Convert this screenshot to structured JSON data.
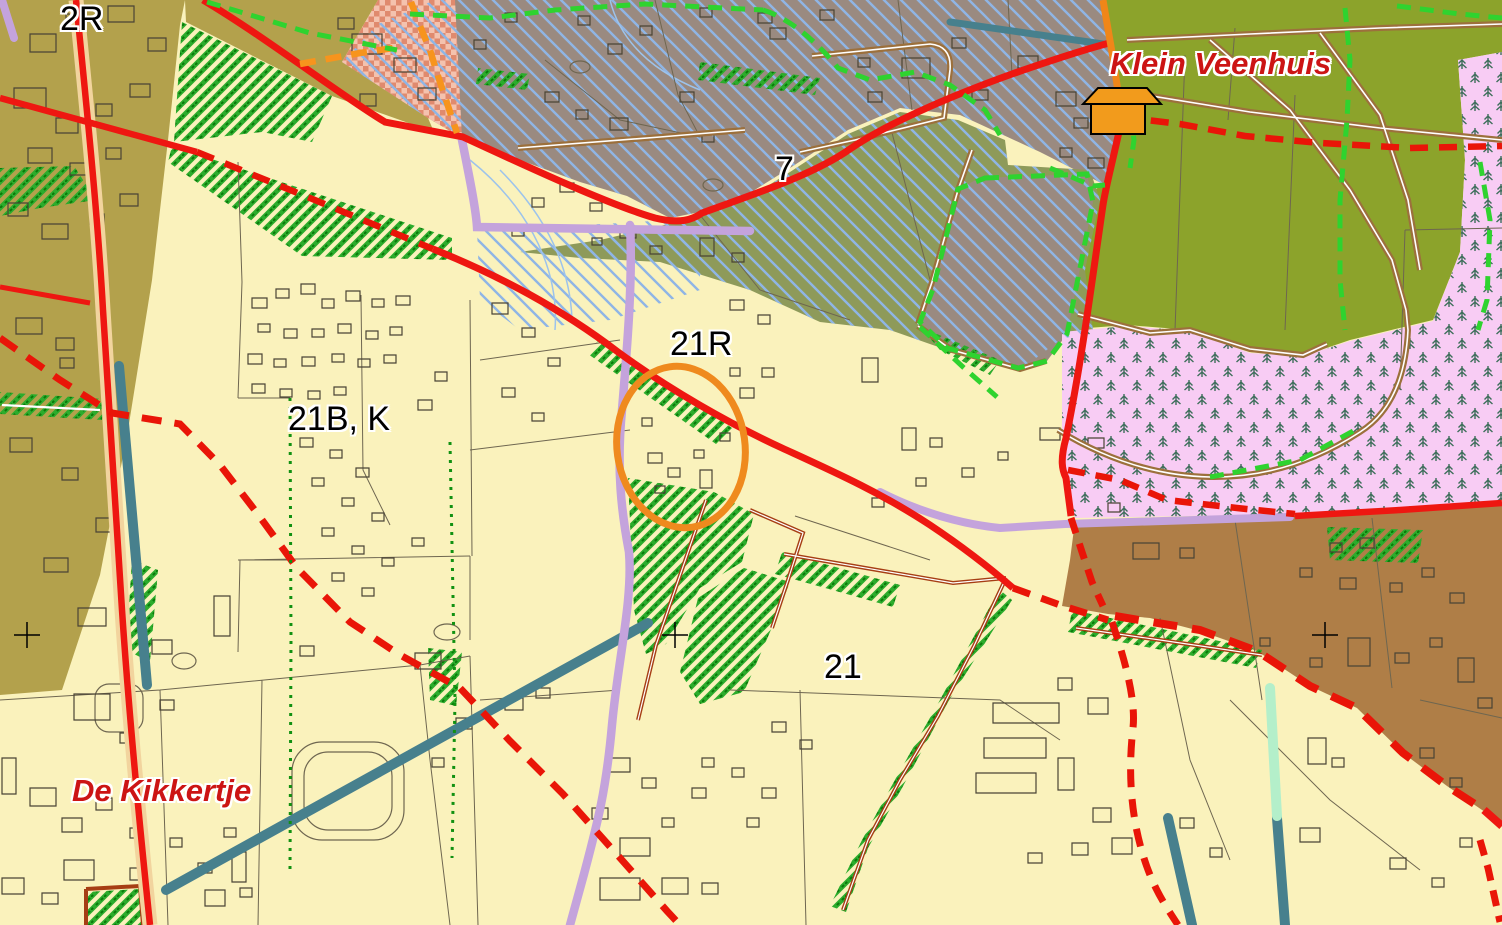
{
  "map": {
    "type": "topographic-zoning-map",
    "labels": {
      "zone_2r": "2R",
      "zone_21bk": "21B, K",
      "zone_21r": "21R",
      "zone_7": "7",
      "zone_21": "21",
      "place_klein_veenhuis": "Klein Veenhuis",
      "place_de_kikkertje": "De Kikkertje"
    },
    "palette": {
      "base_parcel": "#FAF2BC",
      "olive_zone": "#B3A14C",
      "gray_zone": "#9A8A80",
      "olive_drab_zone": "#8E9A5A",
      "bright_green_zone": "#8CA32B",
      "forest_pink": "#F8CCF4",
      "forest_tree": "#3D6E5A",
      "brown_zone": "#AF7E47",
      "checker_salmon": "#E08A6E",
      "road_red": "#EE1711",
      "road_casing": "#F2D49E",
      "road_purple": "#C4A3DC",
      "road_brown": "#9C703C",
      "hedge_red_brown": "#A63E14",
      "boundary_green_dash": "#2FD32F",
      "boundary_orange_dash": "#F7941D",
      "hatch_green": "#2CAC2C",
      "hatch_blue": "#8FB5E5",
      "water_teal": "#47808D",
      "water_mint": "#B4EFCA",
      "marker_orange": "#EF8A1E",
      "label_black": "#000000",
      "label_red": "#CC1414"
    },
    "markers": {
      "selection_ellipse": "orange-ellipse-marker",
      "house_symbol": "orange-house-icon",
      "grid_cross": "+"
    }
  }
}
